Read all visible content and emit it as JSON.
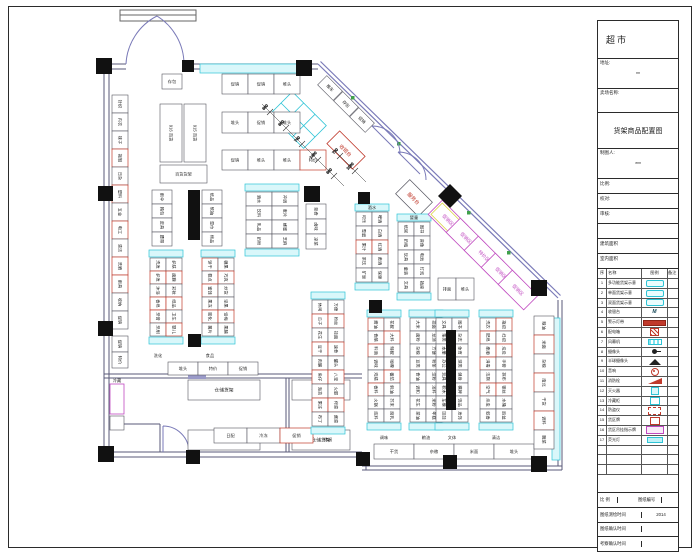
{
  "title_block": {
    "store_type": "超市",
    "address_label": "地址:",
    "address_value": "**",
    "client_label": "卖场名称:",
    "drawing_title": "货架商品配置图",
    "drafter_label": "制图人:",
    "drafter_value": "***",
    "rows": [
      {
        "label": "比例:"
      },
      {
        "label": "校对:"
      },
      {
        "label": "审核:"
      },
      {
        "label": ""
      },
      {
        "label": "建筑面积"
      },
      {
        "label": "室内面积"
      }
    ],
    "legend": {
      "headers": [
        "序号",
        "名称",
        "图例",
        "备注"
      ],
      "rows": [
        {
          "no": "1",
          "name": "多功能货架示意",
          "swatch": "shelf-multi",
          "glyph": "",
          "note": ""
        },
        {
          "no": "2",
          "name": "单面货架示意",
          "swatch": "shelf-single",
          "glyph": "",
          "note": ""
        },
        {
          "no": "3",
          "name": "双面货架示意",
          "swatch": "shelf-double",
          "glyph": "",
          "note": ""
        },
        {
          "no": "4",
          "name": "收银台",
          "swatch": "cashier",
          "glyph": "M",
          "note": ""
        },
        {
          "no": "5",
          "name": "警示灯带",
          "swatch": "warn-light",
          "glyph": "",
          "note": ""
        },
        {
          "no": "6",
          "name": "配电箱",
          "swatch": "power-box",
          "glyph": "",
          "note": ""
        },
        {
          "no": "7",
          "name": "风幕机",
          "swatch": "air-curtain",
          "glyph": "",
          "note": ""
        },
        {
          "no": "8",
          "name": "摄像头",
          "swatch": "camera",
          "glyph": "",
          "note": ""
        },
        {
          "no": "9",
          "name": "半球摄像头",
          "swatch": "dome-camera",
          "glyph": "",
          "note": ""
        },
        {
          "no": "10",
          "name": "音响",
          "swatch": "speaker",
          "glyph": "",
          "note": ""
        },
        {
          "no": "11",
          "name": "消防栓",
          "swatch": "hydrant",
          "glyph": "",
          "note": ""
        },
        {
          "no": "12",
          "name": "灭火器",
          "swatch": "extinguisher",
          "glyph": "",
          "note": ""
        },
        {
          "no": "13",
          "name": "冷藏柜",
          "swatch": "freezer",
          "glyph": "",
          "note": ""
        },
        {
          "no": "14",
          "name": "防盗仪",
          "swatch": "security-gate",
          "glyph": "",
          "note": ""
        },
        {
          "no": "15",
          "name": "货区牌",
          "swatch": "zone-sign",
          "glyph": "",
          "note": ""
        },
        {
          "no": "16",
          "name": "货区吊挂指示牌",
          "swatch": "hanging-sign",
          "glyph": "",
          "note": ""
        },
        {
          "no": "17",
          "name": "荧光灯",
          "swatch": "fluorescent",
          "glyph": "",
          "note": ""
        },
        {
          "no": "",
          "name": "",
          "swatch": "none",
          "glyph": "",
          "note": ""
        },
        {
          "no": "",
          "name": "",
          "swatch": "none",
          "glyph": "",
          "note": ""
        },
        {
          "no": "",
          "name": "",
          "swatch": "none",
          "glyph": "",
          "note": ""
        }
      ]
    },
    "footer": {
      "scale_label": "比 例",
      "scale_value": "",
      "number_label": "图纸编号",
      "number_value": "",
      "survey_label": "图纸测绘时间",
      "survey_value": "2014",
      "confirm_label": "图纸确认时间",
      "confirm_value": "",
      "visit_label": "考察确认时间",
      "visit_value": ""
    }
  },
  "floorplan": {
    "labels": {
      "cashier": "收银台",
      "service": "服务台",
      "storage": "仓储货架"
    },
    "hruns": [
      {
        "x": 162,
        "y": 74,
        "cw": 20,
        "ch": 15,
        "cells": [
          "存包"
        ],
        "red": []
      },
      {
        "x": 222,
        "y": 74,
        "cw": 26,
        "ch": 20,
        "cells": [
          "促销",
          "促销",
          "堆头"
        ],
        "red": []
      },
      {
        "x": 222,
        "y": 112,
        "cw": 26,
        "ch": 21,
        "cells": [
          "堆头",
          "促销",
          "堆头"
        ],
        "red": []
      },
      {
        "x": 222,
        "y": 150,
        "cw": 26,
        "ch": 20,
        "cells": [
          "促销",
          "堆头",
          "堆头",
          "特价"
        ],
        "red": [
          3
        ]
      },
      {
        "x": 160,
        "y": 165,
        "cw": 47,
        "ch": 18,
        "cells": [
          "百货货架"
        ],
        "red": []
      },
      {
        "x": 438,
        "y": 278,
        "cw": 18,
        "ch": 22,
        "cells": [
          "排面",
          "堆头"
        ],
        "red": []
      },
      {
        "x": 168,
        "y": 362,
        "cw": 30,
        "ch": 13,
        "cells": [
          "堆头",
          "特价",
          "促销"
        ],
        "red": []
      },
      {
        "x": 188,
        "y": 380,
        "cw": 72,
        "ch": 20,
        "cells": [
          "仓储货架"
        ],
        "red": [],
        "big": true
      },
      {
        "x": 292,
        "y": 380,
        "cw": 58,
        "ch": 20,
        "cells": [
          "仓储货架"
        ],
        "red": [],
        "big": true
      },
      {
        "x": 188,
        "y": 430,
        "cw": 72,
        "ch": 20,
        "cells": [
          "仓储货架"
        ],
        "red": [],
        "big": true
      },
      {
        "x": 292,
        "y": 430,
        "cw": 58,
        "ch": 20,
        "cells": [
          "仓储货架"
        ],
        "red": [],
        "big": true
      },
      {
        "x": 214,
        "y": 428,
        "cw": 33,
        "ch": 15,
        "cells": [
          "日配",
          "冷冻",
          "促销"
        ],
        "red": [
          2
        ]
      },
      {
        "x": 374,
        "y": 444,
        "cw": 40,
        "ch": 15,
        "cells": [
          "干货",
          "杂粮",
          "米面",
          "堆头"
        ],
        "red": []
      }
    ],
    "vruns": [
      {
        "x": 112,
        "y": 95,
        "cw": 16,
        "ch": 18,
        "rows": 13,
        "caps": false,
        "cols": [
          [
            "针织",
            "内衣",
            "袜子",
            "拖鞋",
            "日杂",
            "塑料",
            "五金",
            "电工",
            "清洁",
            "洗晒",
            "雨具",
            "收纳",
            "促销"
          ]
        ],
        "red": [
          3,
          5,
          7,
          9,
          10
        ]
      },
      {
        "x": 112,
        "y": 336,
        "cw": 16,
        "ch": 16,
        "rows": 2,
        "caps": false,
        "cols": [
          [
            "促销",
            "特价"
          ]
        ],
        "red": []
      },
      {
        "x": 160,
        "y": 104,
        "cw": 22,
        "ch": 58,
        "rows": 1,
        "caps": false,
        "cols": [
          [
            "916 百货"
          ]
        ],
        "red": []
      },
      {
        "x": 184,
        "y": 104,
        "cw": 22,
        "ch": 58,
        "rows": 1,
        "caps": false,
        "cols": [
          [
            "915 百货"
          ]
        ],
        "red": []
      },
      {
        "x": 152,
        "y": 190,
        "cw": 20,
        "ch": 14,
        "rows": 4,
        "caps": false,
        "cols": [
          [
            "雨伞",
            "箱包",
            "皮具",
            "腰带"
          ]
        ],
        "red": []
      },
      {
        "x": 202,
        "y": 190,
        "cw": 20,
        "ch": 14,
        "rows": 4,
        "caps": false,
        "cols": [
          [
            "纸品",
            "软抽",
            "湿巾",
            "棉品"
          ]
        ],
        "red": []
      },
      {
        "x": 150,
        "y": 258,
        "cw": 16,
        "ch": 13,
        "rows": 6,
        "caps": true,
        "cols": [
          [
            "洗发",
            "护发",
            "沐浴",
            "香皂",
            "牙膏",
            "牙刷"
          ],
          [
            "护肤",
            "面膜",
            "彩妆",
            "纸品",
            "卫生",
            "婴儿"
          ]
        ],
        "red": [
          1,
          3,
          4,
          7,
          9,
          11
        ]
      },
      {
        "x": 202,
        "y": 258,
        "cw": 16,
        "ch": 13,
        "rows": 6,
        "caps": true,
        "cols": [
          [
            "饼干",
            "糕点",
            "蜜饯",
            "果冻",
            "膨化",
            "薯片"
          ],
          [
            "糖果",
            "巧克",
            "炒货",
            "坚果",
            "话梅",
            "果脯"
          ]
        ],
        "red": [
          0,
          2,
          4,
          7,
          10
        ]
      },
      {
        "x": 246,
        "y": 192,
        "cw": 26,
        "ch": 14,
        "rows": 4,
        "caps": true,
        "cols": [
          [
            "酒水",
            "饮料",
            "乳品",
            "奶粉"
          ],
          [
            "冲调",
            "麦片",
            "蜂蜜",
            "芝麻"
          ]
        ],
        "red": []
      },
      {
        "x": 306,
        "y": 204,
        "cw": 20,
        "ch": 15,
        "rows": 3,
        "caps": false,
        "cols": [
          [
            "熟食",
            "卤味",
            "凉菜"
          ]
        ],
        "red": []
      },
      {
        "x": 356,
        "y": 212,
        "cw": 16,
        "ch": 14,
        "rows": 5,
        "caps": true,
        "cols": [
          [
            "可乐",
            "雪碧",
            "果汁",
            "茶饮",
            "矿泉"
          ],
          [
            "啤酒",
            "白酒",
            "红酒",
            "黄酒",
            "保健"
          ]
        ],
        "red": [
          2,
          7
        ]
      },
      {
        "x": 398,
        "y": 222,
        "cw": 16,
        "ch": 14,
        "rows": 5,
        "caps": true,
        "cols": [
          [
            "纸尿",
            "奶瓶",
            "玩具",
            "童装",
            "文具"
          ],
          [
            "图书",
            "音像",
            "电池",
            "灯泡",
            "插座"
          ]
        ],
        "red": []
      },
      {
        "x": 312,
        "y": 300,
        "cw": 16,
        "ch": 14,
        "rows": 9,
        "caps": true,
        "cols": [
          [
            "休闲",
            "瓜子",
            "花生",
            "豆干",
            "肉脯",
            "鱼仔",
            "海苔",
            "果冻",
            "布丁"
          ],
          [
            "方便",
            "粉丝",
            "挂面",
            "速食",
            "罐头",
            "八宝",
            "火腿",
            "榨菜",
            "酱菜"
          ]
        ],
        "red": [
          1,
          3,
          5,
          7,
          10,
          12,
          14,
          16
        ]
      },
      {
        "x": 368,
        "y": 318,
        "cw": 16,
        "ch": 13,
        "rows": 8,
        "caps": true,
        "cols": [
          [
            "酱油",
            "食醋",
            "料酒",
            "调味",
            "鸡精",
            "香料",
            "火锅",
            "底料"
          ],
          [
            "花椒",
            "大料",
            "辣椒",
            "咖喱",
            "番茄",
            "蚝油",
            "芥末",
            "腐乳"
          ]
        ],
        "red": [
          0,
          2,
          5,
          9,
          12
        ]
      },
      {
        "x": 410,
        "y": 318,
        "cw": 16,
        "ch": 13,
        "rows": 8,
        "caps": true,
        "cols": [
          [
            "大米",
            "面粉",
            "杂粮",
            "豆类",
            "食油",
            "调和",
            "花生",
            "菜油"
          ],
          [
            "挂面",
            "龙须",
            "方便",
            "粉条",
            "淀粉",
            "汤料",
            "米粉",
            "年糕"
          ]
        ],
        "red": []
      },
      {
        "x": 436,
        "y": 318,
        "cw": 16,
        "ch": 13,
        "rows": 8,
        "caps": true,
        "cols": [
          [
            "文具",
            "笔类",
            "本册",
            "办公",
            "玩具",
            "积木",
            "车模",
            "娃娃"
          ],
          [
            "图书",
            "杂志",
            "体育",
            "球类",
            "健身",
            "棋牌",
            "饰品",
            "发饰"
          ]
        ],
        "red": []
      },
      {
        "x": 480,
        "y": 318,
        "cw": 16,
        "ch": 13,
        "rows": 8,
        "caps": true,
        "cols": [
          [
            "洗衣",
            "肥皂",
            "柔顺",
            "消毒",
            "洁厕",
            "空气",
            "杀虫",
            "蚊香"
          ],
          [
            "拖把",
            "扫把",
            "垃圾",
            "手套",
            "抹布",
            "钢丝",
            "水桶",
            "脸盆"
          ]
        ],
        "red": [
          1,
          3,
          5,
          8,
          10,
          13
        ]
      },
      {
        "x": 534,
        "y": 316,
        "cw": 20,
        "ch": 19,
        "rows": 7,
        "caps": false,
        "cols": [
          [
            "粮油",
            "米面",
            "杂粮",
            "南北",
            "干货",
            "调料",
            "腌菜"
          ]
        ],
        "red": [
          1,
          3,
          5
        ]
      }
    ],
    "diag_cells": [
      {
        "cx": 330,
        "cy": 88,
        "label": "推车"
      },
      {
        "cx": 346,
        "cy": 104,
        "label": "存包"
      },
      {
        "cx": 362,
        "cy": 120,
        "label": "促销"
      }
    ],
    "diag_boxes": [
      {
        "cx": 448,
        "cy": 220,
        "label": "促销区",
        "yellow": true
      },
      {
        "cx": 466,
        "cy": 238,
        "label": "促销区",
        "yellow": false
      },
      {
        "cx": 484,
        "cy": 256,
        "label": "特价区",
        "yellow": false
      },
      {
        "cx": 501,
        "cy": 273,
        "label": "促销区",
        "yellow": false
      },
      {
        "cx": 518,
        "cy": 290,
        "label": "促销区",
        "yellow": false
      }
    ],
    "dims1": [
      "660",
      "660",
      "740",
      "1480",
      "660"
    ],
    "dims2": [
      "730",
      "1060"
    ],
    "texts": [
      {
        "x": 158,
        "y": 357,
        "t": "洗化"
      },
      {
        "x": 210,
        "y": 357,
        "t": "食品"
      },
      {
        "x": 328,
        "y": 441,
        "t": "休闲"
      },
      {
        "x": 384,
        "y": 439,
        "t": "调味"
      },
      {
        "x": 426,
        "y": 439,
        "t": "粮油"
      },
      {
        "x": 452,
        "y": 439,
        "t": "文体"
      },
      {
        "x": 496,
        "y": 439,
        "t": "清洁"
      },
      {
        "x": 372,
        "y": 209,
        "t": "酒水"
      },
      {
        "x": 414,
        "y": 219,
        "t": "婴童"
      },
      {
        "x": 117,
        "y": 382,
        "t": "冷藏"
      }
    ]
  }
}
